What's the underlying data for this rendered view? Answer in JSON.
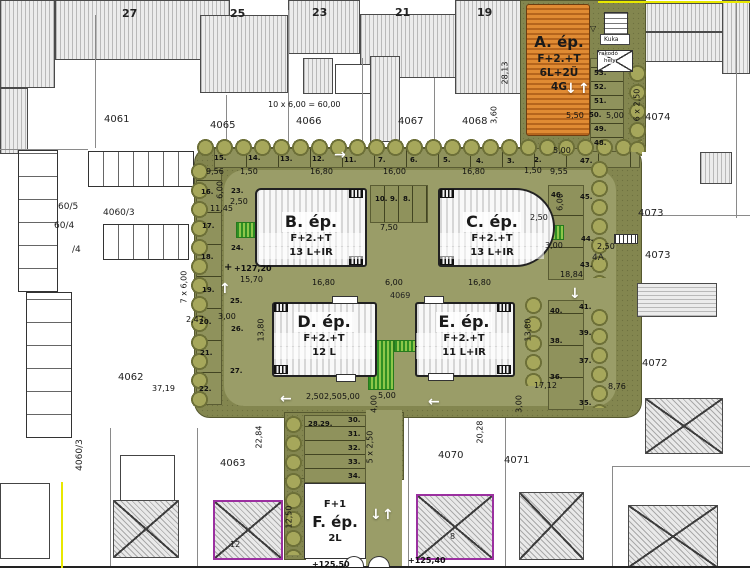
{
  "buildings": {
    "a": {
      "name": "A. ép.",
      "floors": "F+2.+T",
      "units": "6L+2Ü",
      "garages": "4G"
    },
    "b": {
      "name": "B. ép.",
      "floors": "F+2.+T",
      "units": "13 L+IR"
    },
    "c": {
      "name": "C. ép.",
      "floors": "F+2.+T",
      "units": "13 L+IR"
    },
    "d": {
      "name": "D. ép.",
      "floors": "F+2.+T",
      "units": "12 L"
    },
    "e": {
      "name": "E. ép.",
      "floors": "F+2.+T",
      "units": "11 L+IR"
    },
    "f": {
      "name": "F. ép.",
      "floors": "F+1",
      "units": "2L"
    }
  },
  "street_numbers": {
    "n27": "27",
    "n25": "25",
    "n23": "23",
    "n21": "21",
    "n19": "19"
  },
  "parcels": {
    "p4061": "4061",
    "p4065": "4065",
    "p4066": "4066",
    "p4067": "4067",
    "p4068": "4068",
    "p4074": "4074",
    "p4073a": "4073",
    "p4073b": "4073",
    "p4072": "4072",
    "p4070": "4070",
    "p4071": "4071",
    "p4063": "4063",
    "p4062": "4062",
    "p4069": "4069",
    "p605": "60/5",
    "p40603": "4060/3",
    "p604": "60/4",
    "p4": "/4",
    "p40603v": "4060/3",
    "p4a": "4A",
    "h12": "12",
    "h8": "8"
  },
  "dims": {
    "top_formula": "10 x 6,00 = 60,00",
    "v2813": "28,13",
    "v360": "3,60",
    "d550": "5,50",
    "d500a": "5,00",
    "d500b": "5,00",
    "v6x250": "6 x 2,50",
    "d956": "9,56",
    "d150a": "1,50",
    "d1680a": "16,80",
    "d1600": "16,00",
    "d1680b": "16,80",
    "d150b": "1,50",
    "d955": "9,55",
    "d750": "7,50",
    "d250c": "2,50",
    "v600r": "6,00",
    "d300r": "3,00",
    "d1680c": "16,80",
    "d600c": "6,00",
    "d1680d": "16,80",
    "d1570": "15,70",
    "d1145": "11,45",
    "v600l": "6,00",
    "d250l": "2,50",
    "v1380l": "13,80",
    "v1380r": "13,80",
    "d247": "2,47",
    "d300l": "3,00",
    "d3719": "37,19",
    "d1712": "17,12",
    "v300b": "3,00",
    "d1884": "18,84",
    "d250r": "2,50",
    "d876": "8,76",
    "d250s1": "2,50",
    "d250s2": "2,50",
    "d500s1": "5,00",
    "d500s2": "5,00",
    "v400": "4,00",
    "v5x250": "5 x 2,50",
    "v2284": "22,84",
    "v1250": "12,50",
    "v2028": "20,28",
    "v7x600": "7 x 6,00"
  },
  "elevations": {
    "e12720": "+127,20",
    "e12550": "+125,50",
    "e12540": "+125,40"
  },
  "site_labels": {
    "kuka": "Kuka",
    "rakodo1": "rakodó",
    "rakodo2": "hely"
  },
  "parking": {
    "top": [
      "15.",
      "14.",
      "13.",
      "12.",
      "11.",
      "7.",
      "6.",
      "5.",
      "4.",
      "3.",
      "2."
    ],
    "mid": [
      "10.",
      "9.",
      "8."
    ],
    "left": [
      "16.",
      "17.",
      "18.",
      "19.",
      "20.",
      "21.",
      "22."
    ],
    "inner_left": [
      "23.",
      "24.",
      "25.",
      "26.",
      "27."
    ],
    "bottom": [
      "28.",
      "29.",
      "30.",
      "31.",
      "32.",
      "33.",
      "34."
    ],
    "right_lower": [
      "41.",
      "40.",
      "39.",
      "38.",
      "37.",
      "36.",
      "35."
    ],
    "right_upper": [
      "47.",
      "46.",
      "45.",
      "44.",
      "43."
    ],
    "a_col": [
      "48.",
      "49.",
      "50.",
      "51.",
      "52.",
      "53."
    ]
  },
  "icons": {
    "arrow_up": "↑",
    "arrow_down": "↓",
    "arrow_left": "←",
    "arrow_right": "→",
    "benchmark": "+",
    "triangle": "▽"
  },
  "colors": {
    "site_olive": "#83864f",
    "road_olive": "#9a9d68",
    "building_orange": "#d9791f",
    "playground_green": "#3f9e2a",
    "outline_purple": "#9b30a0",
    "boundary_yellow": "#e8e800"
  }
}
